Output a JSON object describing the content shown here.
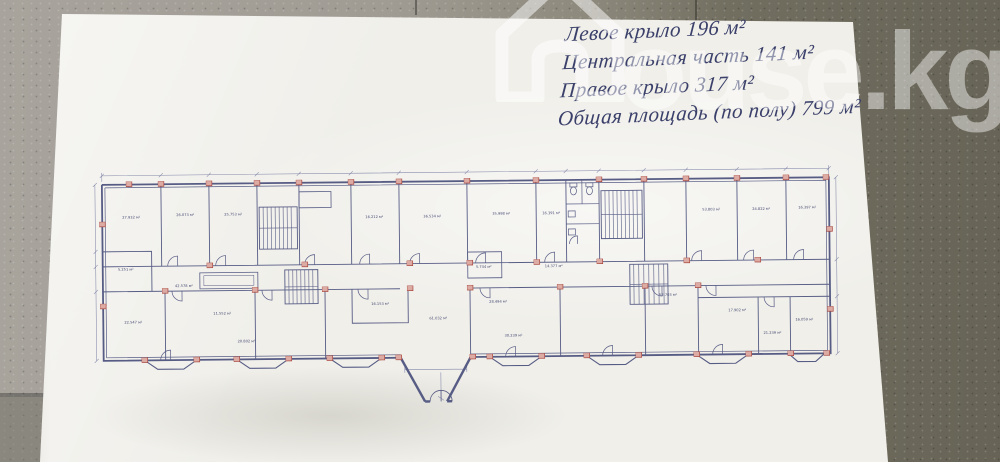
{
  "background": {
    "concrete_left_color": "#a6a29b",
    "concrete_right_color": "#6c695c",
    "paper_color": "#f0efea"
  },
  "watermark": {
    "icon": "house-icon",
    "text": "ouse.kg",
    "color": "#ffffff"
  },
  "handwriting": {
    "ink_color": "#3a406a",
    "lines": [
      "Левое крыло 196 м²",
      "Центральная часть 141 м²",
      "Правое крыло 317 м²",
      "Общая площадь (по полу) 799 м²"
    ]
  },
  "floorplan": {
    "line_color": "#575c85",
    "accent_color": "#a8463e",
    "rooms": [
      {
        "area": "27.932 м²"
      },
      {
        "area": "26.073 м²"
      },
      {
        "area": "25.753 м²"
      },
      {
        "area": "16.212 м²"
      },
      {
        "area": "36.534 м²"
      },
      {
        "area": "35.998 м²"
      },
      {
        "area": "16.391 м²"
      },
      {
        "area": "53.803 м²"
      },
      {
        "area": "24.822 м²"
      },
      {
        "area": "16.397 м²"
      },
      {
        "area": "5.251 м²"
      },
      {
        "area": "42.578 м²"
      },
      {
        "area": "5.744 м²"
      },
      {
        "area": "14.377 м²"
      },
      {
        "area": "22.547 м²"
      },
      {
        "area": "11.552 м²"
      },
      {
        "area": "20.802 м²"
      },
      {
        "area": "16.153 м²"
      },
      {
        "area": "61.032 м²"
      },
      {
        "area": "28.494 м²"
      },
      {
        "area": "30.239 м²"
      },
      {
        "area": "52.703 м²"
      },
      {
        "area": "17.902 м²"
      },
      {
        "area": "21.239 м²"
      },
      {
        "area": "16.059 м²"
      }
    ]
  }
}
